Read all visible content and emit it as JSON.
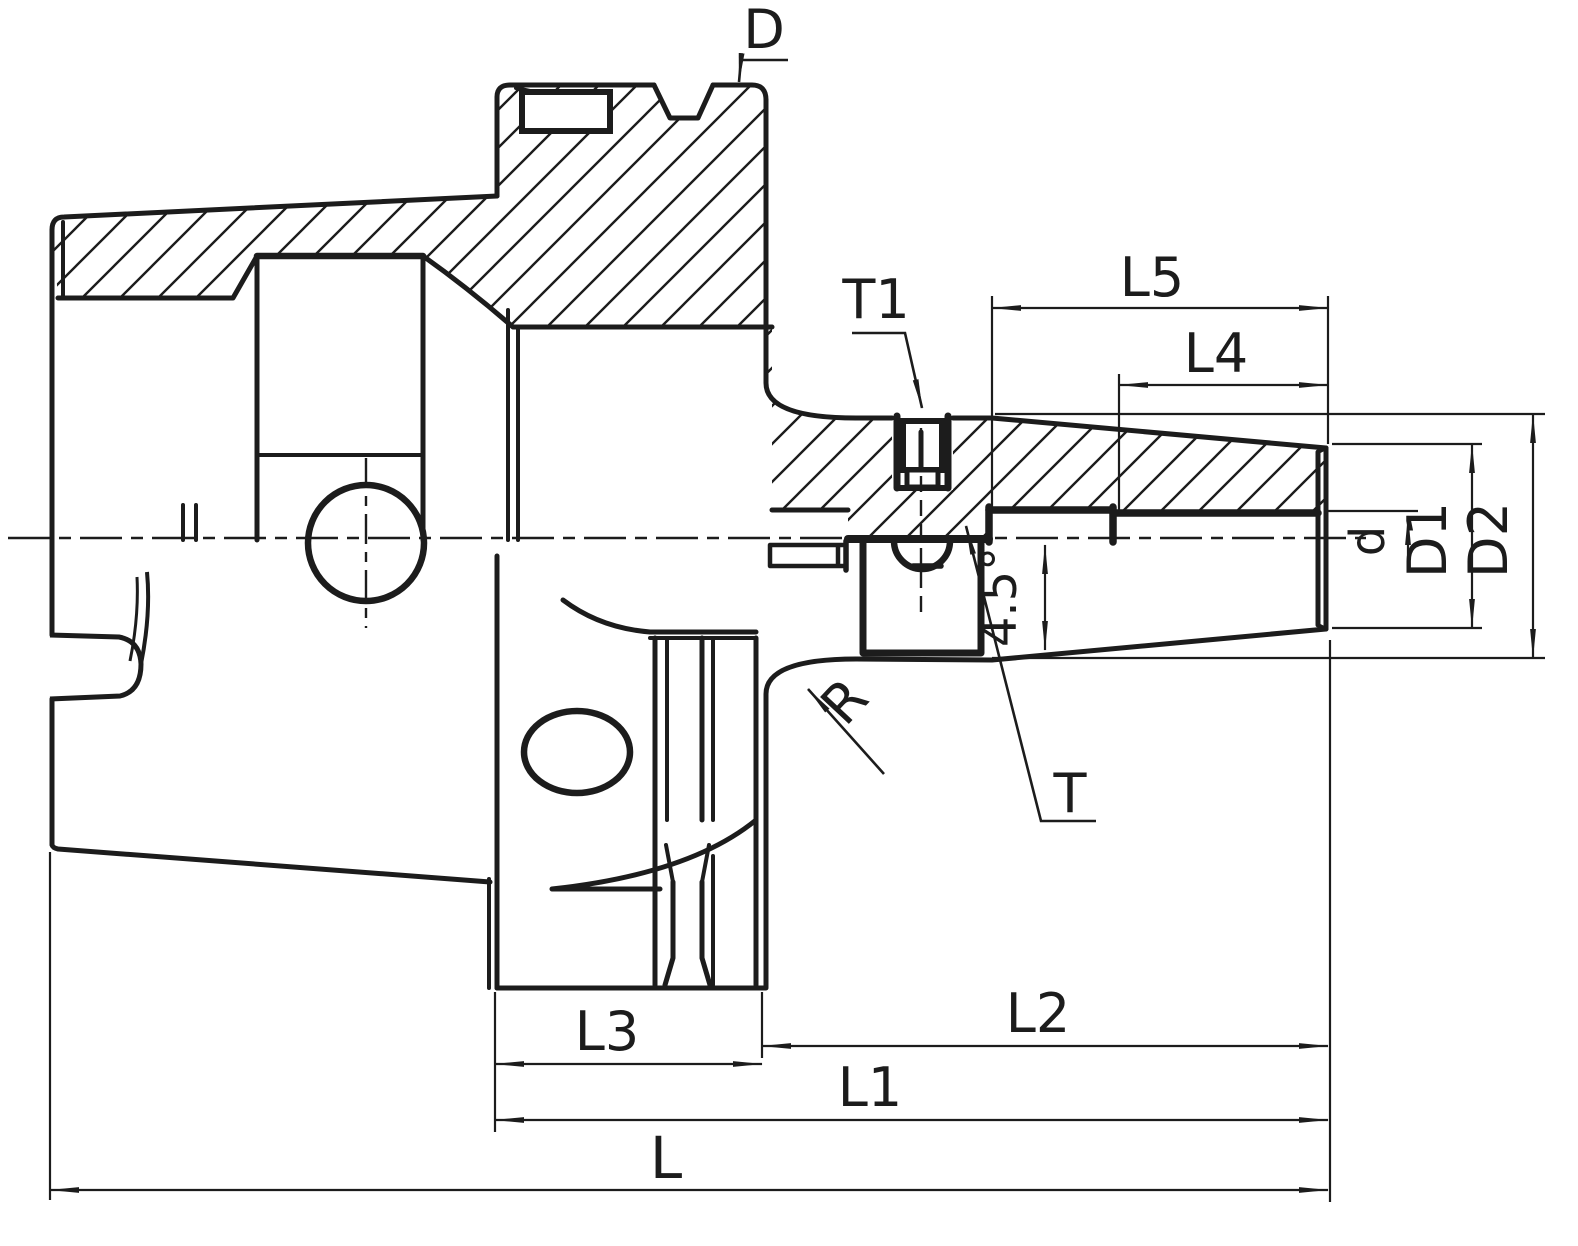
{
  "drawing": {
    "background": "#ffffff",
    "line_color": "#1c1c1c",
    "labels": {
      "D": "D",
      "T1": "T1",
      "L5": "L5",
      "L4": "L4",
      "d": "d",
      "D1": "D1",
      "D2": "D2",
      "angle": "4.5°",
      "T": "T",
      "R": "R",
      "L3": "L3",
      "L2": "L2",
      "L1": "L1",
      "L": "L"
    }
  }
}
